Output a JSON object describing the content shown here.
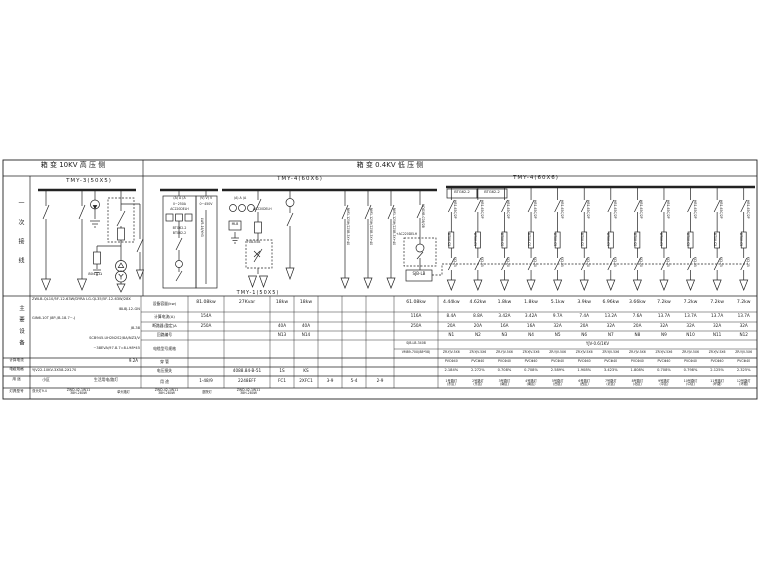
{
  "titles": {
    "hv": "箱 变 10KV 高 压 侧",
    "lv": "箱 变 0.4KV 低 压 侧"
  },
  "left_strip": {
    "section1": "一次接线",
    "section2": "主要设备",
    "row_labels": [
      "计算电流",
      "电缆规格",
      "用 途",
      "灯具型号"
    ]
  },
  "hv_section": {
    "bus_label": "TMY-3(50X5)",
    "ground_label": "8044.Ω",
    "equipment_specs": [
      "ZWLB-QL10/5F-12-63W/DYRA  LG-QL35/5F-12-63W/28X",
      "I8L8J-12-GN",
      "GIN6-10T    J8P-/B-18.7~-J",
      "J8-38",
      "SCB945-UH2N2S2/8A/NZ3/V",
      "~38EVA/97.8.7=8.L98*45"
    ],
    "calc_current": "9.2A",
    "cable_spec": "YJV22-10KV-3X58-2X170",
    "usage": [
      "小区",
      "生活用电/路灯"
    ]
  },
  "lv_section": {
    "bus1_label": "TMY-4(60X6)",
    "bus2_label": "TMY-4(60X6)",
    "riser_label": "TMY-1(50X5)",
    "panel_a": {
      "header": "(A) A (A",
      "range": "0~250A",
      "aux": "AC220DELH",
      "dev1": "BTG62-2",
      "dev2": "BT062-2"
    },
    "panel_v": {
      "header": "(V) V) V",
      "range": "0~450V",
      "selector": "LW5-16/YH3"
    },
    "incoming": {
      "header": "(A) A (A",
      "aux": "AC220DELH",
      "box": "MLB",
      "fuse_box": "FUB-K5B"
    },
    "btg_cells": [
      "BTG62-2",
      "BTG62-2"
    ],
    "bus1_feeders": [
      "NM1-125H/225B-3X+40",
      "NM1-125H/225B-3X+40",
      "NM1-125H/225B-3X+40"
    ],
    "special_feeder": {
      "breaker": "HDGXB-C08/2B",
      "coil": "+AC220DELH",
      "control_box": "SJB-LB"
    },
    "feeders": {
      "breakers": [
        "HB1-63C/2P",
        "HB1-63C/2P",
        "HB1-63C/2P",
        "HB1-63C/2P",
        "HB1-63C/2P",
        "HB1-63C/2P",
        "HB1-63C/2P",
        "HB1-63C/2P",
        "HB1-63C/2P",
        "HB1-63C/2P",
        "HB1-63C/2P",
        "HB1-63C/2P"
      ],
      "meters": [
        "BT08-C5",
        "BT08-C5",
        "BT08-C0",
        "BT08-C0",
        "BT08-C5",
        "BT08-C0",
        "BT08-C5",
        "BT08-C0",
        "BT08-C5",
        "BT08-C5",
        "BT08-C5",
        "BT08-C5"
      ],
      "contactors": [
        "KCJ-25",
        "KCJ-25",
        "KCJ-20",
        "KCJ-20",
        "KCJ-25",
        "KCJ-20",
        "KCJ-25",
        "KCJ-20",
        "KCJ-25",
        "KCJ-25",
        "KCJ-25",
        "KCJ-25"
      ]
    }
  },
  "table": {
    "row_labels": [
      "设备容量(kw)",
      "计算电流(A)",
      "断路器(整定)A",
      "回路编号",
      "电缆型号规格",
      "穿 管",
      "电压损失",
      "用 途"
    ],
    "cols": {
      "A": {
        "r1": "81.08kw",
        "r2": "154A",
        "r3": "250A",
        "r8": "1-48/9"
      },
      "B": {
        "r1": "27Kvar",
        "r7": "4088.84-B-51",
        "r8": "2248EFF"
      },
      "C": {
        "r1": "18kw",
        "r3": "40A",
        "r4": "N13",
        "r7": "1S",
        "r8": "FC1"
      },
      "D": {
        "r1": "18kw",
        "r3": "40A",
        "r4": "N14",
        "r7": "KS",
        "r8": "2XFC1"
      },
      "E": {
        "r8": "3-9"
      },
      "F": {
        "r8": "5-4"
      },
      "G": {
        "r8": "2-9"
      },
      "H": {
        "r1": "61.08kw",
        "r2": "116A",
        "r3": "250A",
        "r5a": "SJB-LB-3408",
        "r5b": "VM89-70X(88*58)"
      }
    },
    "cable_span": "YJV-0.6/1KV",
    "feeders": {
      "capacity": [
        "4.44kw",
        "4.62kw",
        "1.8kw",
        "1.8kw",
        "5.1kw",
        "3.9kw",
        "6.96kw",
        "3.66kw",
        "7.2kw",
        "7.2kw",
        "7.2kw",
        "7.2kw"
      ],
      "current": [
        "8.4A",
        "8.8A",
        "3.42A",
        "3.42A",
        "9.7A",
        "7.4A",
        "13.2A",
        "7.6A",
        "13.7A",
        "13.7A",
        "13.7A",
        "13.7A"
      ],
      "breaker": [
        "20A",
        "20A",
        "16A",
        "16A",
        "32A",
        "20A",
        "32A",
        "20A",
        "32A",
        "32A",
        "32A",
        "32A"
      ],
      "circuit": [
        "N1",
        "N2",
        "N3",
        "N4",
        "N5",
        "N6",
        "N7",
        "N8",
        "N9",
        "N10",
        "N11",
        "N12"
      ],
      "cable": [
        "ZR-YJV-5X6",
        "ZR-YJV-5X6",
        "ZR-YJV-5X6",
        "ZR-YJV-5X6",
        "ZR-YJV-5X6",
        "ZR-YJV-5X6",
        "ZR-YJV-5X6",
        "ZR-YJV-5X6",
        "ZR-YJV-5X6",
        "ZR-YJV-5X6",
        "ZR-YJV-5X6",
        "ZR-YJV-5X6"
      ],
      "conduit": [
        "PVCΦ40",
        "PVCΦ40",
        "PVCΦ40",
        "PVCΦ40",
        "PVCΦ40",
        "PVCΦ40",
        "PVCΦ40",
        "PVCΦ40",
        "PVCΦ40",
        "PVCΦ40",
        "PVCΦ40",
        "PVCΦ40"
      ],
      "vdrop": [
        "2.184%",
        "2.272%",
        "0.708%",
        "0.708%",
        "2.589%",
        "1.908%",
        "3.423%",
        "1.808%",
        "0.708%",
        "0.798%",
        "2.125%",
        "2.325%"
      ],
      "usage": [
        [
          "1号路灯",
          "(东区)"
        ],
        [
          "2号路灯",
          "(东区)"
        ],
        [
          "3号路灯",
          "(南区)"
        ],
        [
          "4号路灯",
          "(南区)"
        ],
        [
          "5号路灯",
          "(西区)"
        ],
        [
          "6号路灯",
          "(西区)"
        ],
        [
          "7号路灯",
          "(北区)"
        ],
        [
          "8号路灯",
          "(北区)"
        ],
        [
          "9号路灯",
          "(中区)"
        ],
        [
          "10号路灯",
          "(中区)"
        ],
        [
          "11号路灯",
          "(环路)"
        ],
        [
          "12号路灯",
          "(环路)"
        ]
      ]
    }
  },
  "bottom_row": {
    "groups": [
      {
        "name": "双头灯9.4",
        "model": "ZWD-42-1W11",
        "lamp": "38H-280W"
      },
      {
        "name": "单头路灯",
        "model": "ZWD-42-1W11",
        "lamp": "38H-280W"
      },
      {
        "name": "庭院灯",
        "model": "ZWD-42-1W11",
        "lamp": "38H-280W"
      }
    ]
  }
}
